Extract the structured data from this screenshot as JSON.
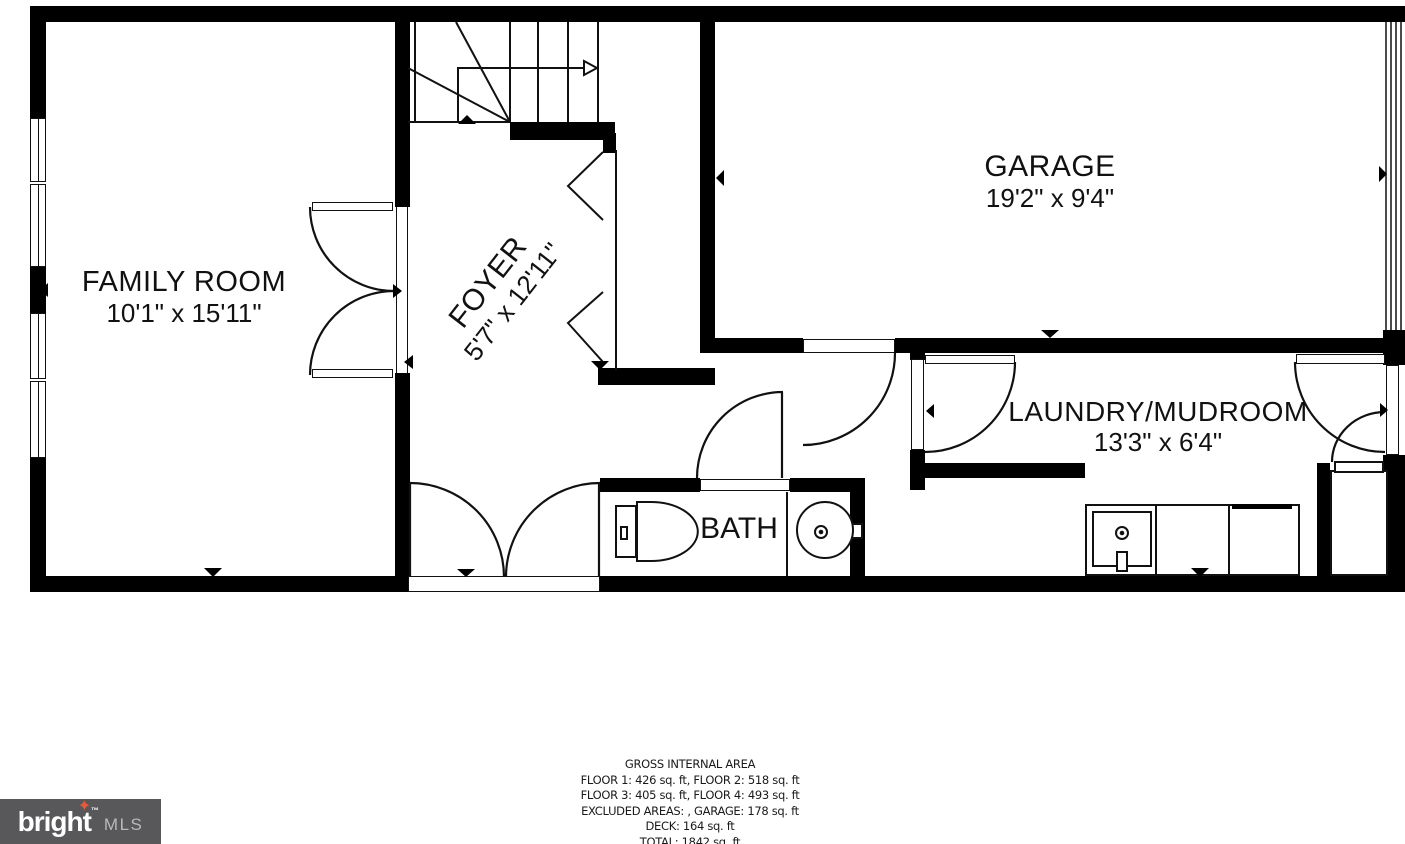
{
  "plan": {
    "rooms": {
      "family_room": {
        "name": "FAMILY ROOM",
        "dims": "10'1\" x 15'11\""
      },
      "foyer": {
        "name": "FOYER",
        "dims": "5'7\" x 12'11\""
      },
      "garage": {
        "name": "GARAGE",
        "dims": "19'2\" x 9'4\""
      },
      "laundry": {
        "name": "LAUNDRY/MUDROOM",
        "dims": "13'3\" x 6'4\""
      },
      "bath": {
        "name": "BATH"
      }
    }
  },
  "area_summary": {
    "title": "GROSS INTERNAL AREA",
    "lines": [
      "FLOOR 1: 426 sq. ft, FLOOR 2: 518 sq. ft",
      "FLOOR 3: 405 sq. ft, FLOOR 4: 493 sq. ft",
      "EXCLUDED AREAS: , GARAGE: 178 sq. ft",
      "DECK: 164 sq. ft",
      "TOTAL: 1842 sq. ft"
    ]
  },
  "logo": {
    "brand_prefix": "brigh",
    "brand_t": "t",
    "star": "✦",
    "tm": "™",
    "suffix": "MLS"
  },
  "colors": {
    "wall": "#000000",
    "line": "#111111",
    "logo_background": "#58585b",
    "logo_star": "#e8593b",
    "logo_mls_text": "#b9b9bb"
  }
}
